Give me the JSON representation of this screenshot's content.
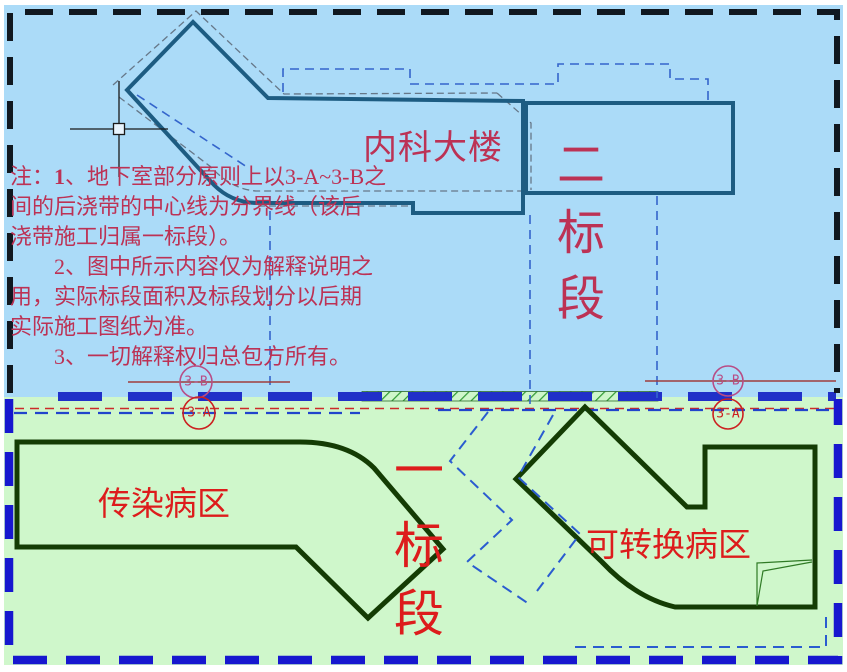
{
  "note": {
    "prefix": "注：",
    "n1": "1",
    "l1": "、地下室部分原则上以3-A~3-B之",
    "l2": "间的后浇带的中心线为分界线（该后",
    "l3": "浇带施工归属一标段）。",
    "l4": "2、图中所示内容仅为解释说明之",
    "l5": "用，实际标段面积及标段划分以后期",
    "l6": "实际施工图纸为准。",
    "l7": "3、一切解释权归总包方所有。"
  },
  "labels": {
    "top_building": "内科大楼",
    "bottom_left_building": "传染病区",
    "bottom_right_building": "可转换病区"
  },
  "sections": {
    "two": [
      "二",
      "标",
      "段"
    ],
    "one": [
      "一",
      "标",
      "段"
    ]
  },
  "grid_markers": {
    "left_b": "3-B",
    "left_a": "3-A",
    "right_b": "3-B",
    "right_a": "3-A"
  },
  "colors": {
    "section2_background": "#abdbf8",
    "section1_background": "#cff7cb",
    "top_building_outline": "#1d5c82",
    "bottom_building_outline": "#143c04",
    "section2_border": "#101820",
    "section1_border": "#1717cf",
    "note_text": "#bc3255",
    "red_label_text": "#dd1c1c",
    "marker_3b": "#b84d86",
    "marker_3a": "#cc2020",
    "joint_band_blue": "#2030c8",
    "hatch_green": "#2f9a35"
  }
}
